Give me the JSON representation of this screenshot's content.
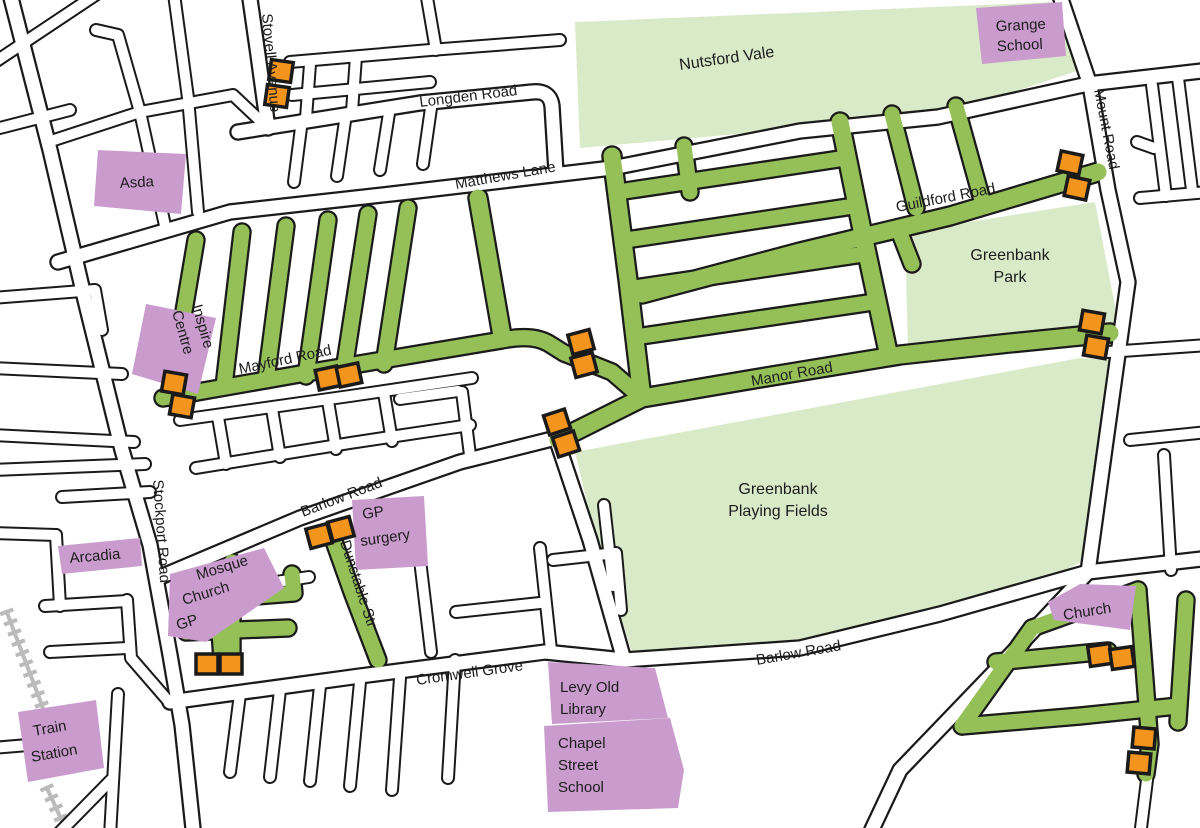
{
  "colors": {
    "green_road": "#94C057",
    "park": "#D9EAC8",
    "poi": "#CA9CCE",
    "marker": "#F3941D",
    "marker_border": "#1A1A1A",
    "casing": "#1A1A1A",
    "railway": "#BBBBBB",
    "background": "#FFFFFF"
  },
  "road_labels": [
    {
      "id": "stovell-avenue",
      "text": "Stovell Avenue"
    },
    {
      "id": "longden-road",
      "text": "Longden Road"
    },
    {
      "id": "matthews-lane",
      "text": "Matthews Lane"
    },
    {
      "id": "mount-road",
      "text": "Mount Road"
    },
    {
      "id": "guildford-road",
      "text": "Guildford Road"
    },
    {
      "id": "mayford-road",
      "text": "Mayford Road"
    },
    {
      "id": "manor-road",
      "text": "Manor Road"
    },
    {
      "id": "stockport-road",
      "text": "Stockport Road"
    },
    {
      "id": "barlow-road-west",
      "text": "Barlow Road"
    },
    {
      "id": "dunstable-str",
      "text": "Dunstable Str"
    },
    {
      "id": "cromwell-grove",
      "text": "Cromwell Grove"
    },
    {
      "id": "barlow-road-east",
      "text": "Barlow Road"
    }
  ],
  "parks": [
    {
      "id": "nutsford-vale",
      "lines": [
        "Nutsford Vale"
      ]
    },
    {
      "id": "greenbank-park",
      "lines": [
        "Greenbank",
        "Park"
      ]
    },
    {
      "id": "greenbank-playing-fields",
      "lines": [
        "Greenbank",
        "Playing Fields"
      ]
    }
  ],
  "pois": [
    {
      "id": "grange-school",
      "lines": [
        "Grange",
        "School"
      ]
    },
    {
      "id": "asda",
      "lines": [
        "Asda"
      ]
    },
    {
      "id": "inspire-centre",
      "lines": [
        "Inspire",
        "Centre"
      ]
    },
    {
      "id": "arcadia",
      "lines": [
        "Arcadia"
      ]
    },
    {
      "id": "mosque-church-gp",
      "lines": [
        "Mosque",
        "Church",
        "GP"
      ]
    },
    {
      "id": "gp-surgery",
      "lines": [
        "GP",
        "surgery"
      ]
    },
    {
      "id": "church",
      "lines": [
        "Church"
      ]
    },
    {
      "id": "levy-old-library",
      "lines": [
        "Levy Old",
        "Library"
      ]
    },
    {
      "id": "chapel-street-school",
      "lines": [
        "Chapel",
        "Street",
        "School"
      ]
    },
    {
      "id": "train-station",
      "lines": [
        "Train",
        "Station"
      ]
    }
  ],
  "markers": [
    {
      "x": 281,
      "y": 71,
      "r": 8
    },
    {
      "x": 277,
      "y": 96,
      "r": 8
    },
    {
      "x": 1070,
      "y": 163,
      "r": 12
    },
    {
      "x": 1077,
      "y": 188,
      "r": 12
    },
    {
      "x": 174,
      "y": 383,
      "r": 10
    },
    {
      "x": 182,
      "y": 406,
      "r": 10
    },
    {
      "x": 328,
      "y": 378,
      "r": -12
    },
    {
      "x": 349,
      "y": 375,
      "r": -12
    },
    {
      "x": 581,
      "y": 342,
      "r": -15
    },
    {
      "x": 584,
      "y": 365,
      "r": -15
    },
    {
      "x": 557,
      "y": 422,
      "r": -18
    },
    {
      "x": 566,
      "y": 444,
      "r": -18
    },
    {
      "x": 1092,
      "y": 322,
      "r": 10
    },
    {
      "x": 1096,
      "y": 347,
      "r": 10
    },
    {
      "x": 319,
      "y": 536,
      "r": -15
    },
    {
      "x": 341,
      "y": 529,
      "r": -15
    },
    {
      "x": 207,
      "y": 664,
      "r": 0
    },
    {
      "x": 231,
      "y": 664,
      "r": 0
    },
    {
      "x": 1100,
      "y": 655,
      "r": -8
    },
    {
      "x": 1122,
      "y": 658,
      "r": -8
    },
    {
      "x": 1144,
      "y": 738,
      "r": 5
    },
    {
      "x": 1139,
      "y": 763,
      "r": 5
    }
  ]
}
